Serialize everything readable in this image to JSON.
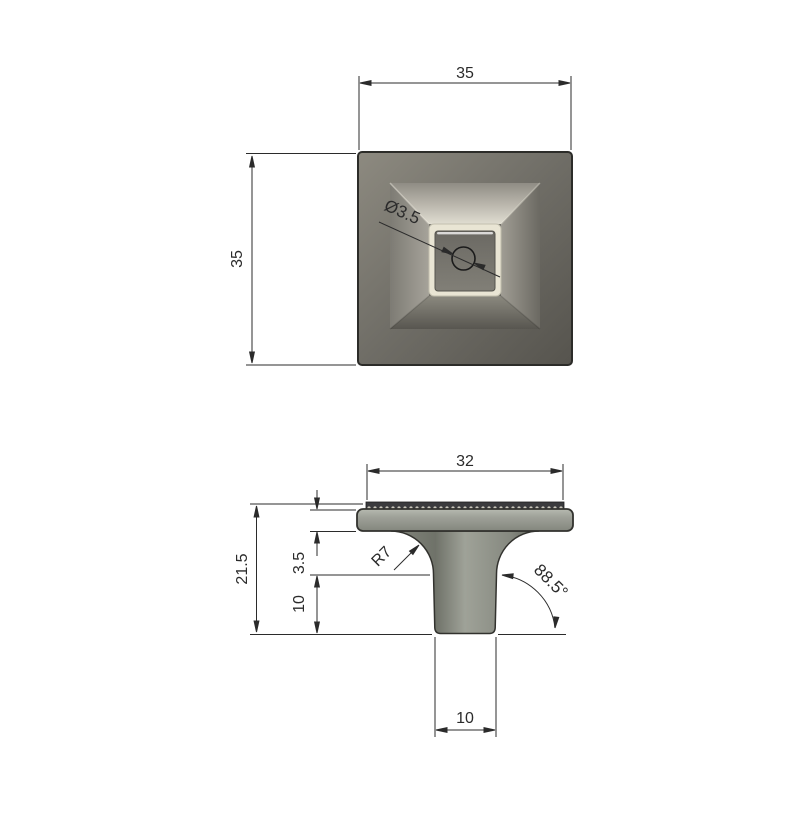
{
  "drawing": {
    "type": "CAD technical drawing - square cabinet knob, two orthographic views",
    "background_color": "#ffffff",
    "line_color": "#2b2b2b",
    "top_view": {
      "name": "top view",
      "width_label": "35",
      "height_label": "35",
      "hole_diameter_label": "Ø3.5",
      "colors": {
        "face": "#6f6d66",
        "bevel_highlight": "#e0ddd1",
        "ring": "#e9e5d4",
        "inner_square": "#74726b"
      }
    },
    "front_view": {
      "name": "front view",
      "cap_width_label": "32",
      "total_height_label": "21.5",
      "cap_thickness_label": "3.5",
      "stem_height_label": "10",
      "stem_width_label": "10",
      "fillet_radius_label": "R7",
      "side_angle_label": "88.5°",
      "colors": {
        "body": "#9fa298",
        "knurl_band": "#3b3b3e"
      }
    }
  }
}
